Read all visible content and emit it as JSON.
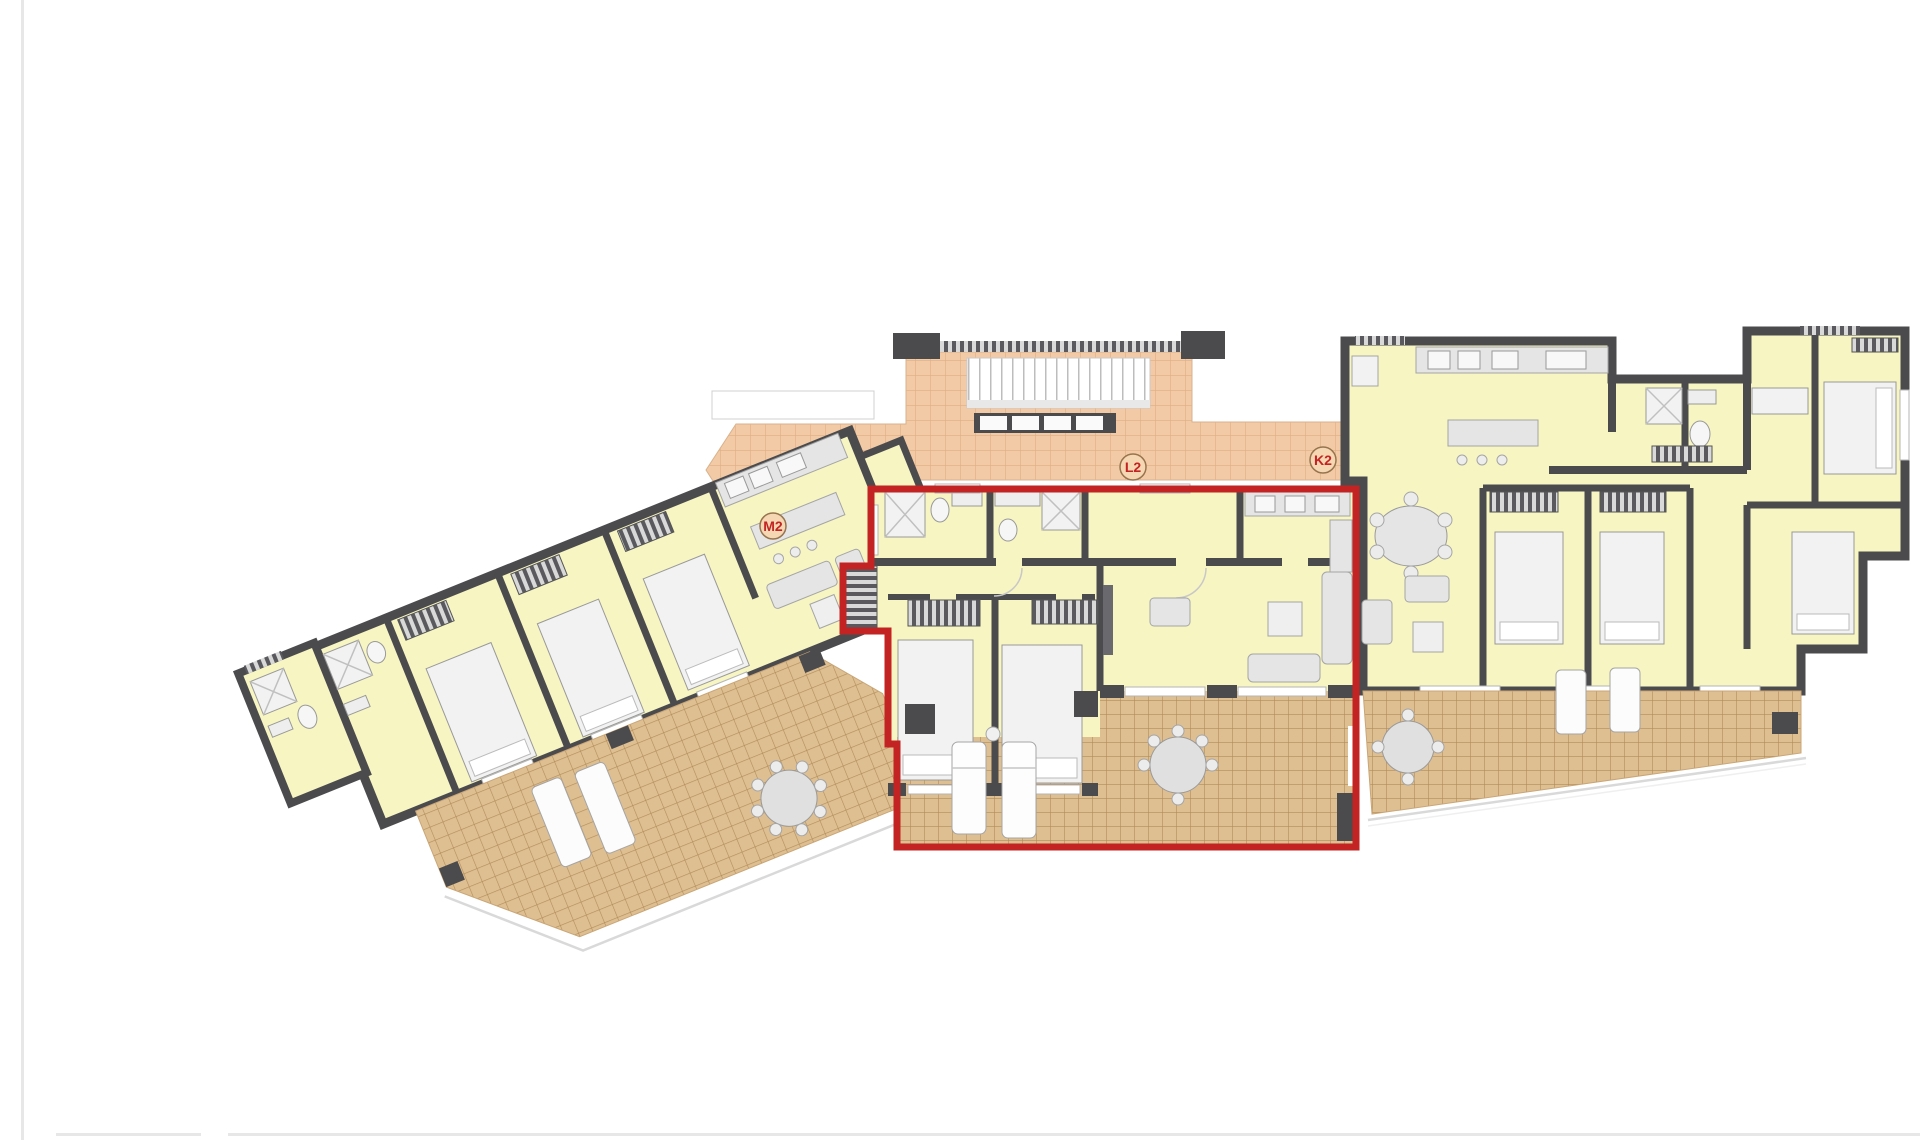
{
  "document": {
    "kind": "architectural floor plan drawing",
    "description": "Top-floor apartment block plan with three units; the centre unit is outlined in red as the highlighted property"
  },
  "plan": {
    "highlighted_unit_label": "L2",
    "unit_labels": [
      {
        "id": "M2",
        "x": 773,
        "y": 526
      },
      {
        "id": "L2",
        "x": 1133,
        "y": 467
      },
      {
        "id": "K2",
        "x": 1323,
        "y": 460
      }
    ],
    "colors": {
      "paper": "#ffffff",
      "page_line": "#e7e7e7",
      "wall": "#4b4b4e",
      "room": "#f7f5c2",
      "walk_tile": "#f2cba6",
      "walk_grid": "#dfad82",
      "terrace_tile": "#debf92",
      "terrace_grid": "#b28c58",
      "highlight": "#c32322",
      "furniture_fill": "#e5e5e5",
      "furniture_line": "#9a9a9a",
      "fixture_fill": "#f2f2f2",
      "window": "#ffffff",
      "railing": "#d9d9d9"
    }
  }
}
